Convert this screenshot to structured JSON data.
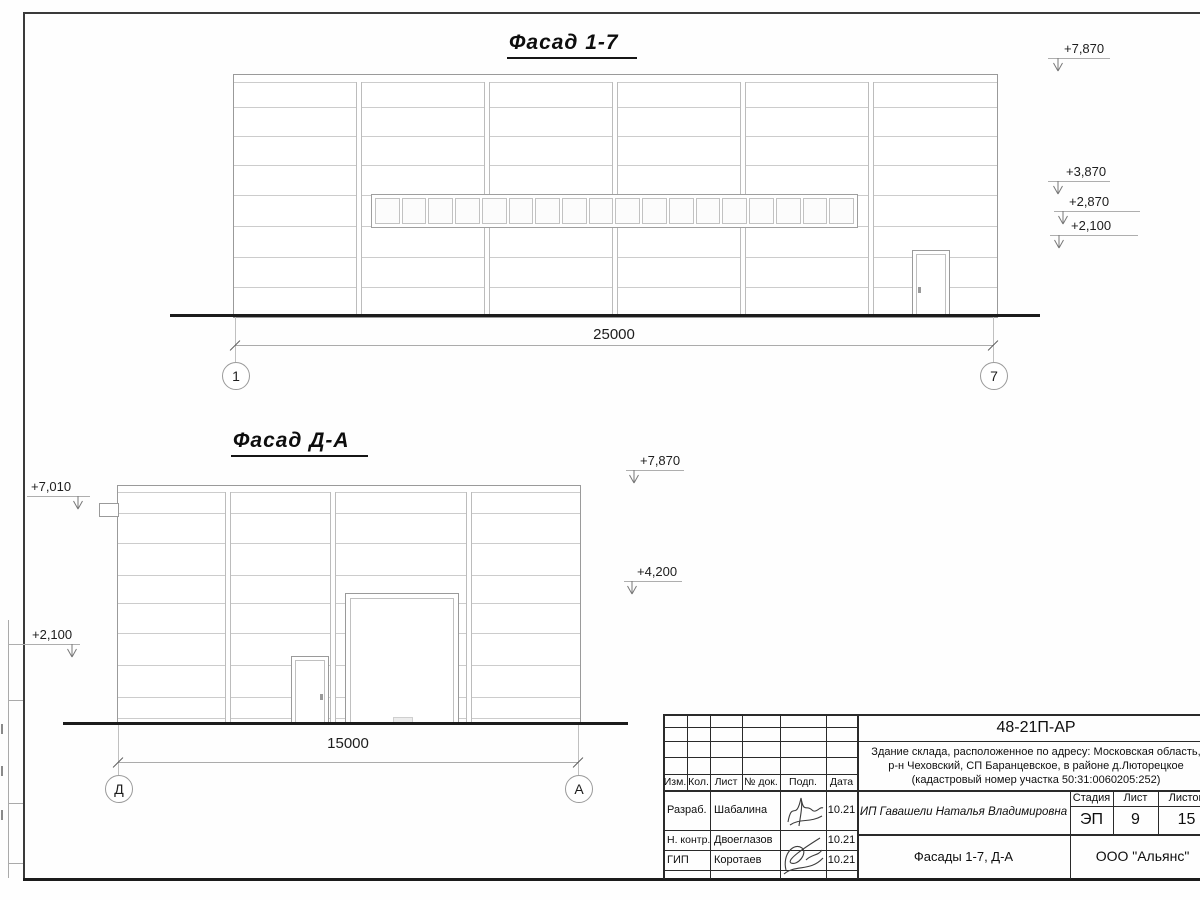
{
  "facade_1_7": {
    "title": "Фасад 1-7",
    "dimension": "25000",
    "axis_left": "1",
    "axis_right": "7",
    "elevations": [
      "+7,870",
      "+3,870",
      "+2,870",
      "+2,100"
    ]
  },
  "facade_d_a": {
    "title": "Фасад Д-А",
    "dimension": "15000",
    "axis_left": "Д",
    "axis_right": "А",
    "elevations_left": [
      "+7,010",
      "+2,100"
    ],
    "elevations_right": [
      "+7,870",
      "+4,200"
    ]
  },
  "title_block": {
    "document_number": "48-21П-АР",
    "address_line1": "Здание склада, расположенное по адресу: Московская область,",
    "address_line2": "р-н Чеховский, СП Баранцевское, в районе д.Люторецкое",
    "address_line3": "(кадастровый номер участка 50:31:0060205:252)",
    "columns": {
      "izm": "Изм.",
      "kol": "Кол.",
      "list": "Лист",
      "doc": "№ док.",
      "podp": "Подп.",
      "data": "Дата"
    },
    "roles": [
      {
        "role": "Разраб.",
        "name": "Шабалина",
        "date": "10.21"
      },
      {
        "role": "Н. контр.",
        "name": "Двоеглазов",
        "date": "10.21"
      },
      {
        "role": "ГИП",
        "name": "Коротаев",
        "date": "10.21"
      }
    ],
    "client": "ИП Гавашели Наталья Владимировна",
    "stage_label": "Стадия",
    "sheet_label": "Лист",
    "sheets_label": "Листов",
    "stage": "ЭП",
    "sheet_number": "9",
    "sheets_total": "15",
    "drawing_title": "Фасады 1-7, Д-А",
    "company": "ООО \"Альянс\""
  }
}
